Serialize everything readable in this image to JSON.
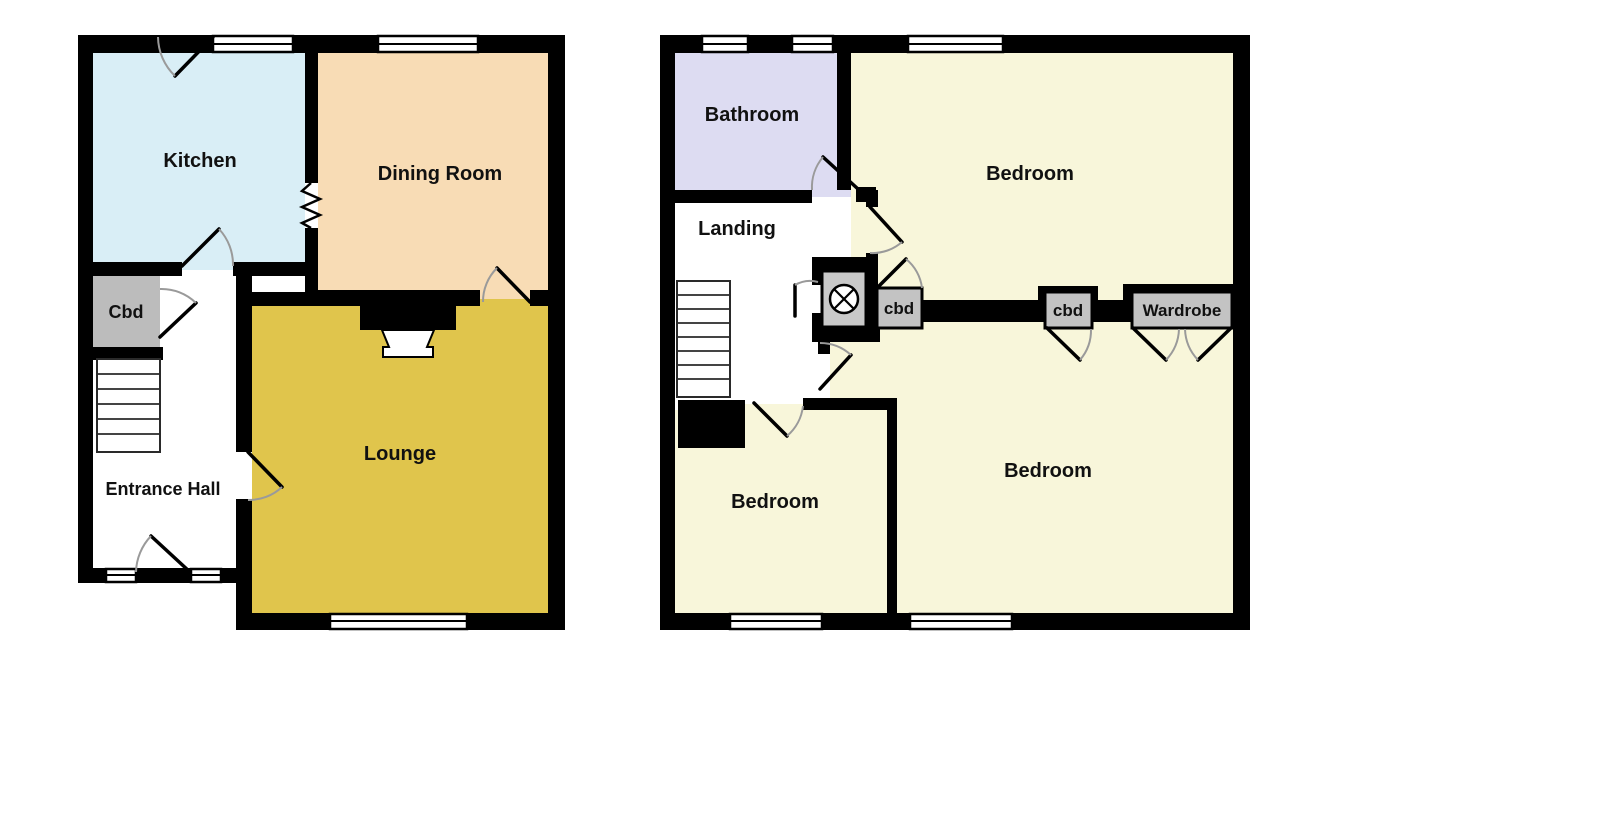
{
  "plans": {
    "ground_floor": {
      "rooms": {
        "kitchen": {
          "label": "Kitchen",
          "color": "#d9eef6"
        },
        "dining_room": {
          "label": "Dining Room",
          "color": "#f8dcb5"
        },
        "lounge": {
          "label": "Lounge",
          "color": "#e0c54c"
        },
        "cbd": {
          "label": "Cbd",
          "color": "#bcbcbc"
        },
        "entrance_hall": {
          "label": "Entrance Hall",
          "color": "#ffffff"
        }
      }
    },
    "first_floor": {
      "rooms": {
        "bathroom": {
          "label": "Bathroom",
          "color": "#dddcf2"
        },
        "landing": {
          "label": "Landing",
          "color": "#ffffff"
        },
        "bedroom_front": {
          "label": "Bedroom",
          "color": "#f8f6da"
        },
        "bedroom_back": {
          "label": "Bedroom",
          "color": "#f8f6da"
        },
        "bedroom_small": {
          "label": "Bedroom",
          "color": "#f8f6da"
        },
        "cbd_1": {
          "label": "cbd",
          "color": "#c3c3c3"
        },
        "cbd_2": {
          "label": "cbd",
          "color": "#c3c3c3"
        },
        "wardrobe": {
          "label": "Wardrobe",
          "color": "#c3c3c3"
        },
        "airing_cupboard": {
          "label": "",
          "color": "#c9c9c9"
        }
      }
    }
  },
  "palette": {
    "wall": "#000000",
    "window_fill": "#ffffff",
    "door_leaf": "#000000",
    "door_arc": "#9a9a9a",
    "background": "#ffffff"
  }
}
